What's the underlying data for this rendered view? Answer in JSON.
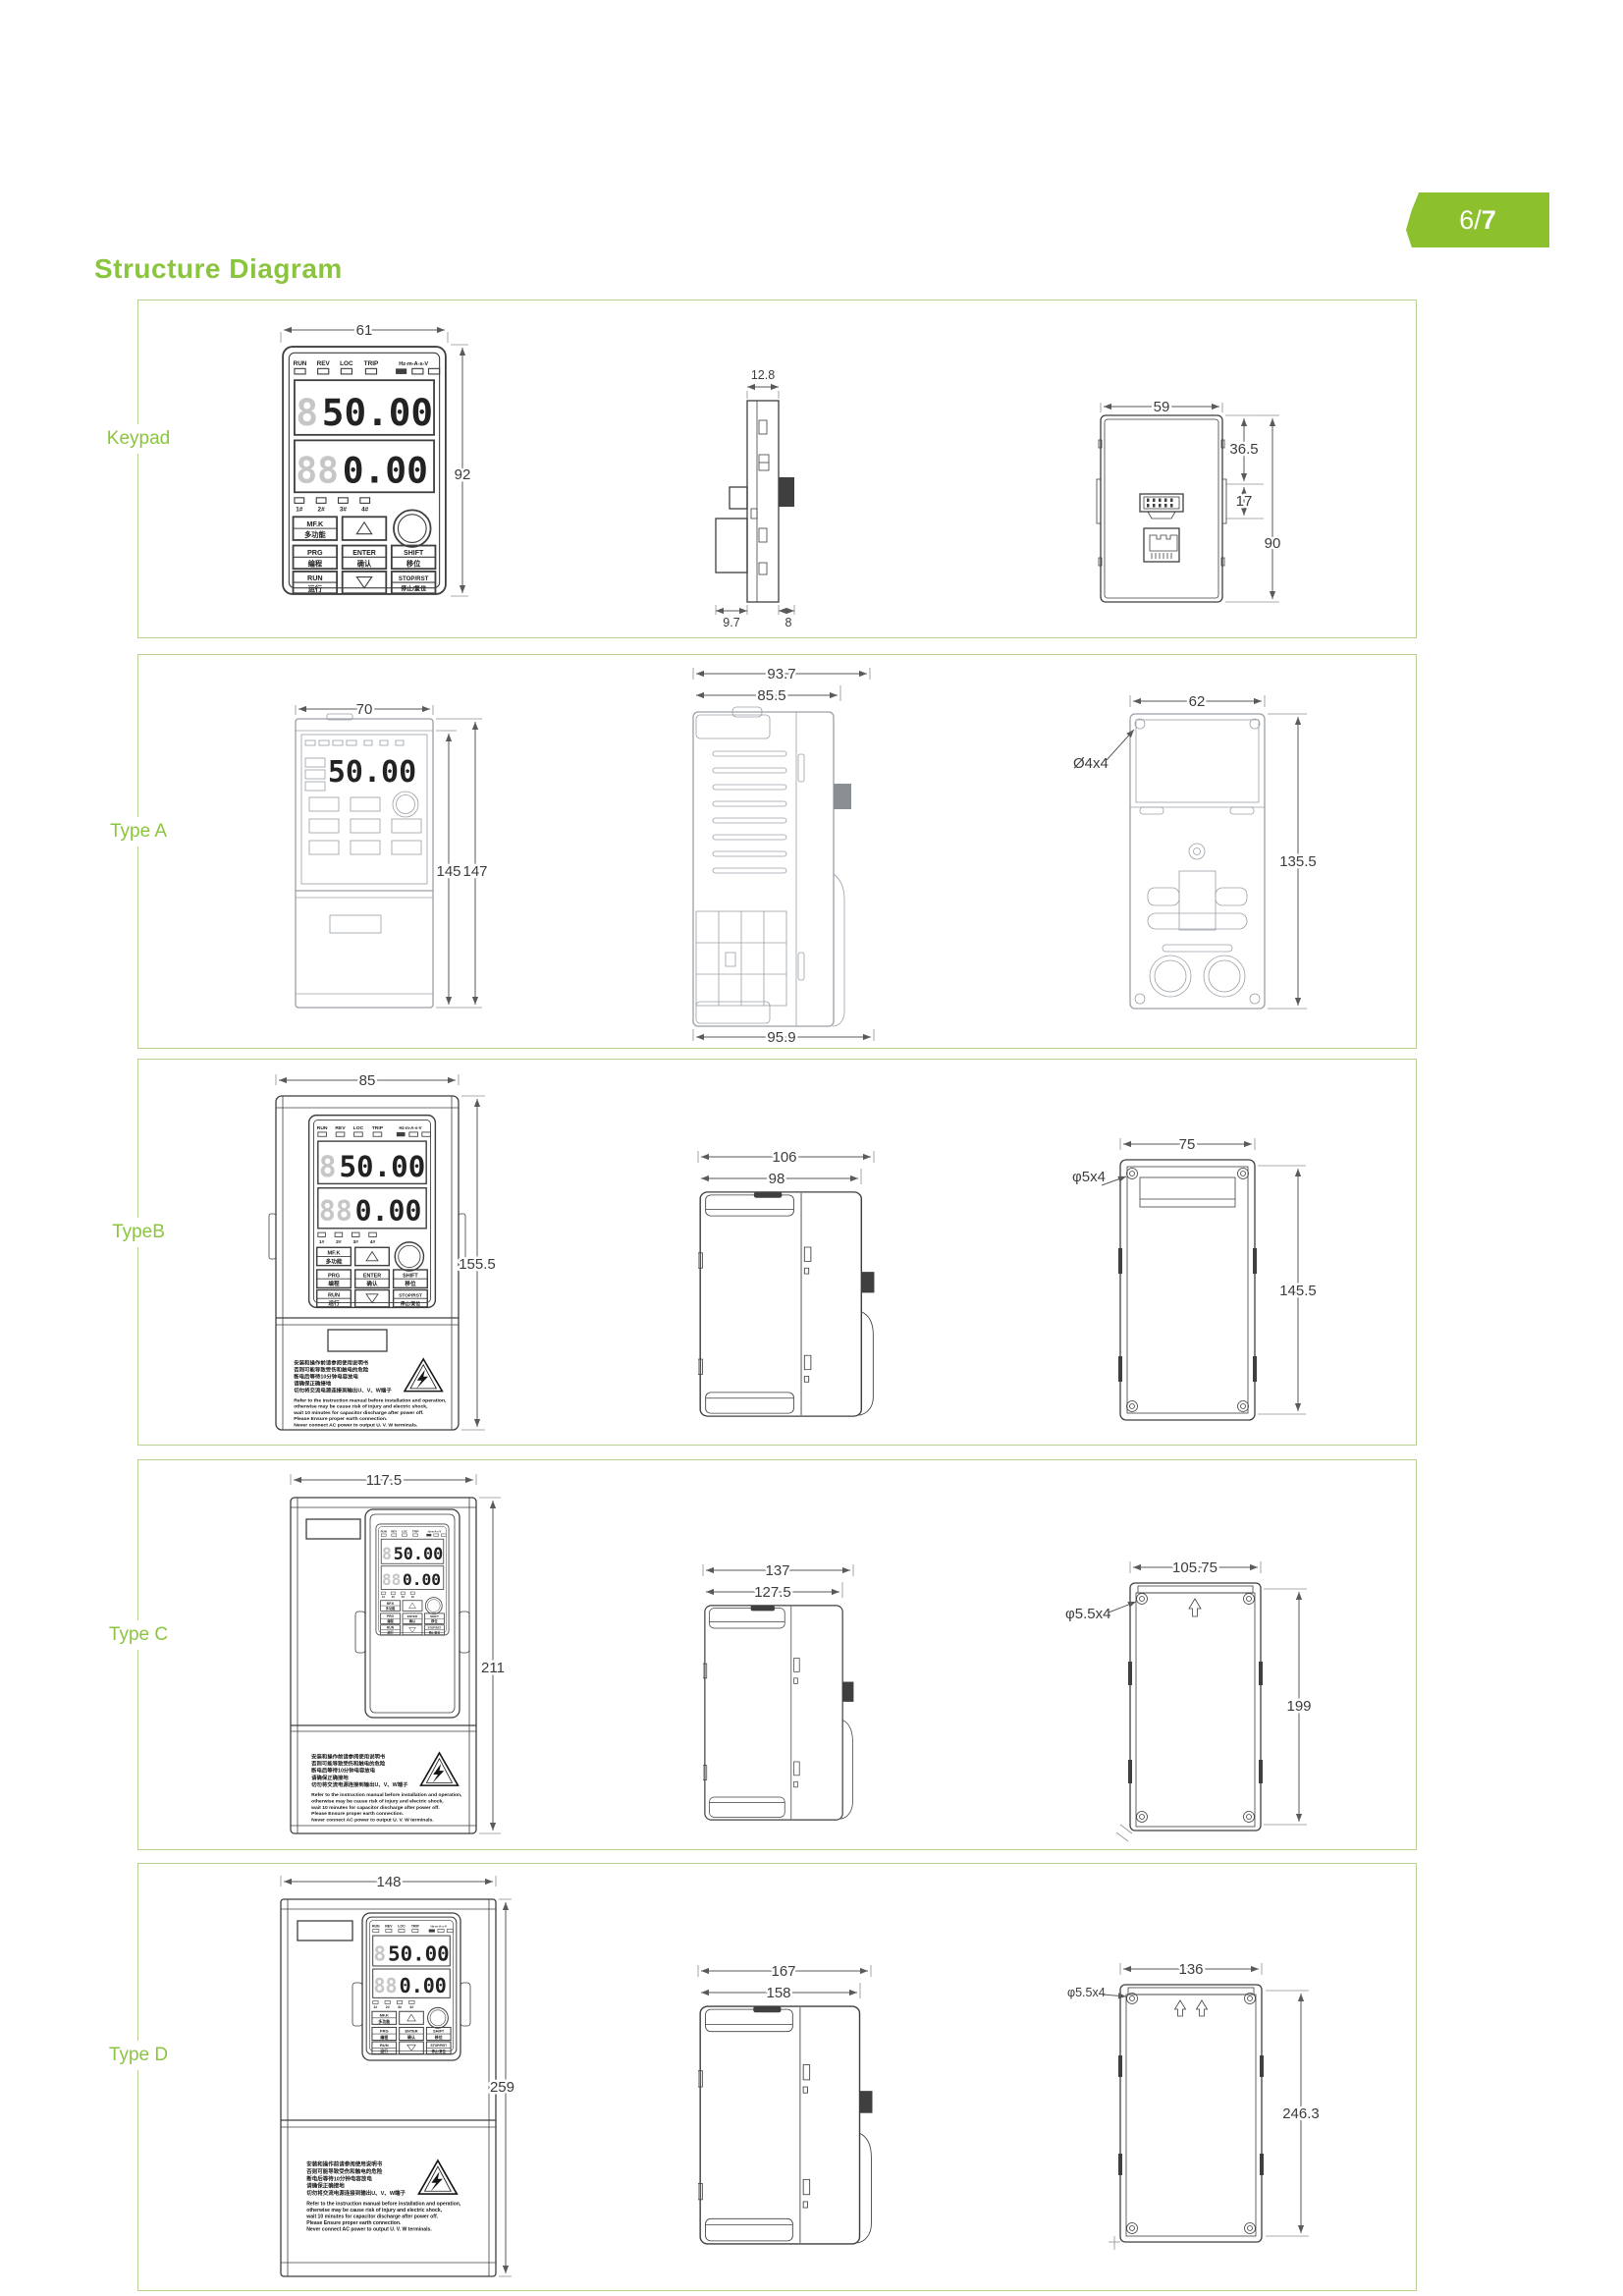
{
  "page": {
    "badge_num": "6/",
    "badge_total": "7",
    "title": "Structure Diagram"
  },
  "colors": {
    "accent": "#8cc02d",
    "title_green": "#8bc53f",
    "panel_border": "#bccf92",
    "line_dark": "#3f3f3f",
    "line_faint": "#9aa0a6",
    "dim": "#3c3c3c"
  },
  "keypad_ui": {
    "led_labels": [
      "RUN",
      "REV",
      "LOC",
      "TRIP",
      "Hz-m-A-s-V"
    ],
    "display_top_ghost": "8",
    "display_top": "50.00",
    "display_bottom_ghost": "88",
    "display_bottom": "0.00",
    "small_leds": [
      "1#",
      "2#",
      "3#",
      "4#"
    ],
    "buttons": {
      "mfk_top": "MF.K",
      "mfk_bottom": "多功能",
      "prg_top": "PRG",
      "prg_bottom": "编程",
      "enter_top": "ENTER",
      "enter_bottom": "确认",
      "shift_top": "SHIFT",
      "shift_bottom": "移位",
      "run_top": "RUN",
      "run_bottom": "运行",
      "stop_top": "STOP/RST",
      "stop_bottom": "停止/复位"
    }
  },
  "warning": {
    "cn": [
      "安装和操作前请参阅使用说明书",
      "否则可能导致受伤和触电的危险",
      "断电后等待10分钟电容放电",
      "请确保正确接地",
      "切勿将交流电源连接到输出U、V、W端子"
    ],
    "en": [
      "Refer to the instruction manual before installation and operation,",
      "otherwise may be cause risk of injury and electric shock,",
      "wait 10 minutes for capacitor discharge after power off.",
      "Please Ensure proper earth connection.",
      "Never connect AC power to output U. V. W terminals."
    ]
  },
  "rows": [
    {
      "label": "Keypad",
      "front": {
        "width": "61",
        "height": "92"
      },
      "side": {
        "top": "12.8",
        "bottom_left": "9.7",
        "bottom_right": "8"
      },
      "back": {
        "width": "59",
        "upper": "36.5",
        "mid": "17",
        "height": "90"
      }
    },
    {
      "label": "Type A",
      "front": {
        "width": "70",
        "height_inner": "145",
        "height": "147"
      },
      "side": {
        "depth": "93.7",
        "depth_inner": "85.5",
        "depth_bottom": "95.9"
      },
      "back": {
        "width": "62",
        "holes": "Ø4x4",
        "height": "135.5"
      }
    },
    {
      "label": "TypeB",
      "front": {
        "width": "85",
        "height": "155.5"
      },
      "side": {
        "depth": "106",
        "depth_inner": "98"
      },
      "back": {
        "width": "75",
        "holes": "φ5x4",
        "height": "145.5"
      }
    },
    {
      "label": "Type C",
      "front": {
        "width": "117.5",
        "height": "211"
      },
      "side": {
        "depth": "137",
        "depth_inner": "127.5"
      },
      "back": {
        "width": "105.75",
        "holes": "φ5.5x4",
        "height": "199"
      }
    },
    {
      "label": "Type D",
      "front": {
        "width": "148",
        "height": "259"
      },
      "side": {
        "depth": "167",
        "depth_inner": "158"
      },
      "back": {
        "width": "136",
        "holes": "φ5.5x4",
        "height": "246.3"
      }
    }
  ]
}
